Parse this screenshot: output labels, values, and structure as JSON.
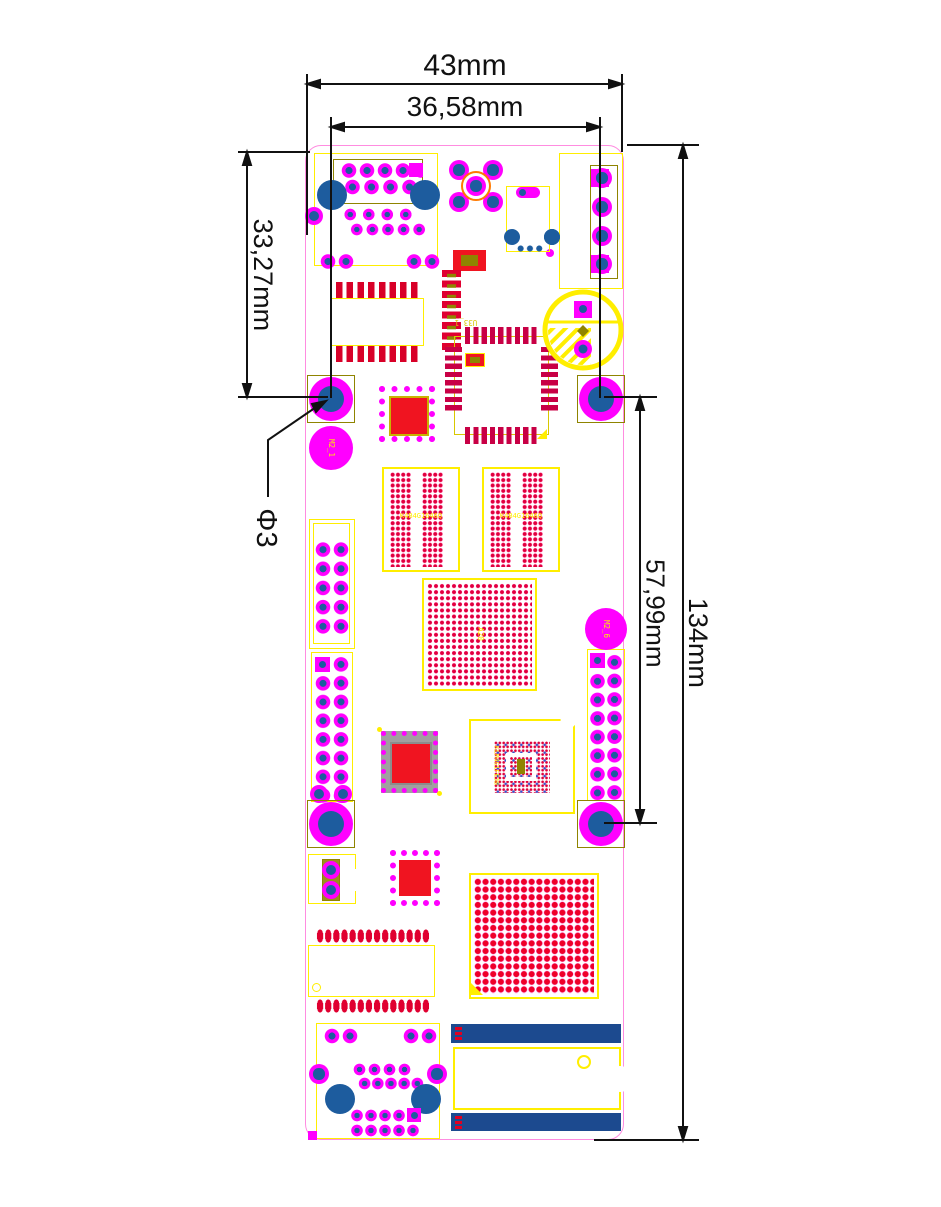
{
  "drawing": {
    "type": "pcb-mechanical-dimension-drawing",
    "dim_width_total": "43mm",
    "dim_hole_span_x": "36,58mm",
    "dim_hole_offset_y": "33,27mm",
    "dim_hole_span_y": "57,99mm",
    "dim_height_total": "134mm",
    "dim_hole_diameter": "Φ3"
  },
  "silkscreen": {
    "hole_label_top_left": "M2_1",
    "pad_label_right": "M2_6",
    "ddr_left": "K4B4G1646Q",
    "ddr_right": "K4B4G1646Q",
    "cpu": "A20",
    "emmc": "KLM4G1FE3B",
    "qfp": "U33_1"
  },
  "palette": {
    "board_outline_pink": "#ff8ce0",
    "silk_yellow": "#ffee00",
    "component_olive": "#8f8400",
    "pad_magenta": "#ff00ff",
    "drill_blue": "#1d5c9e",
    "smd_red": "#f01420",
    "qfp_pad_crimson": "#c80045",
    "slot_navy": "#1c4a8f",
    "dimension_black": "#111111",
    "button_ring_orange": "#ff7a00"
  }
}
